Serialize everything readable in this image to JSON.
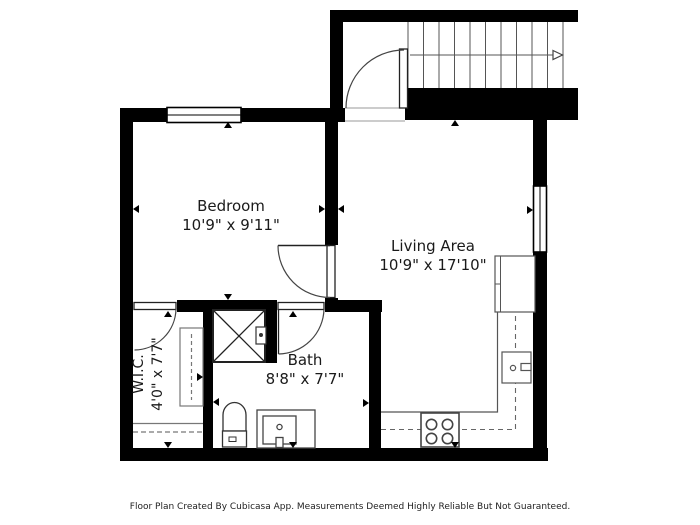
{
  "floor_plan": {
    "rooms": [
      {
        "id": "bedroom",
        "name": "Bedroom",
        "dimensions": "10'9\" x 9'11\""
      },
      {
        "id": "living",
        "name": "Living Area",
        "dimensions": "10'9\" x 17'10\""
      },
      {
        "id": "bath",
        "name": "Bath",
        "dimensions": "8'8\" x 7'7\""
      },
      {
        "id": "wic",
        "name": "W.I.C.",
        "dimensions": "4'0\" x 7'7\""
      }
    ],
    "features": [
      "staircase-with-up-arrow",
      "entry-door",
      "bedroom-door",
      "bath-door",
      "wic-door",
      "shower",
      "toilet",
      "sink-vanity",
      "kitchen-counter",
      "stove",
      "kitchen-sink",
      "refrigerator",
      "wardrobe",
      "closet-rod",
      "bedroom-window",
      "living-window"
    ],
    "colors": {
      "wall": "#000000",
      "fixture_outline": "#444444",
      "background": "#ffffff",
      "text": "#1a1a1a"
    }
  },
  "footer": {
    "disclaimer": "Floor Plan Created By Cubicasa App. Measurements Deemed Highly Reliable But Not Guaranteed."
  }
}
